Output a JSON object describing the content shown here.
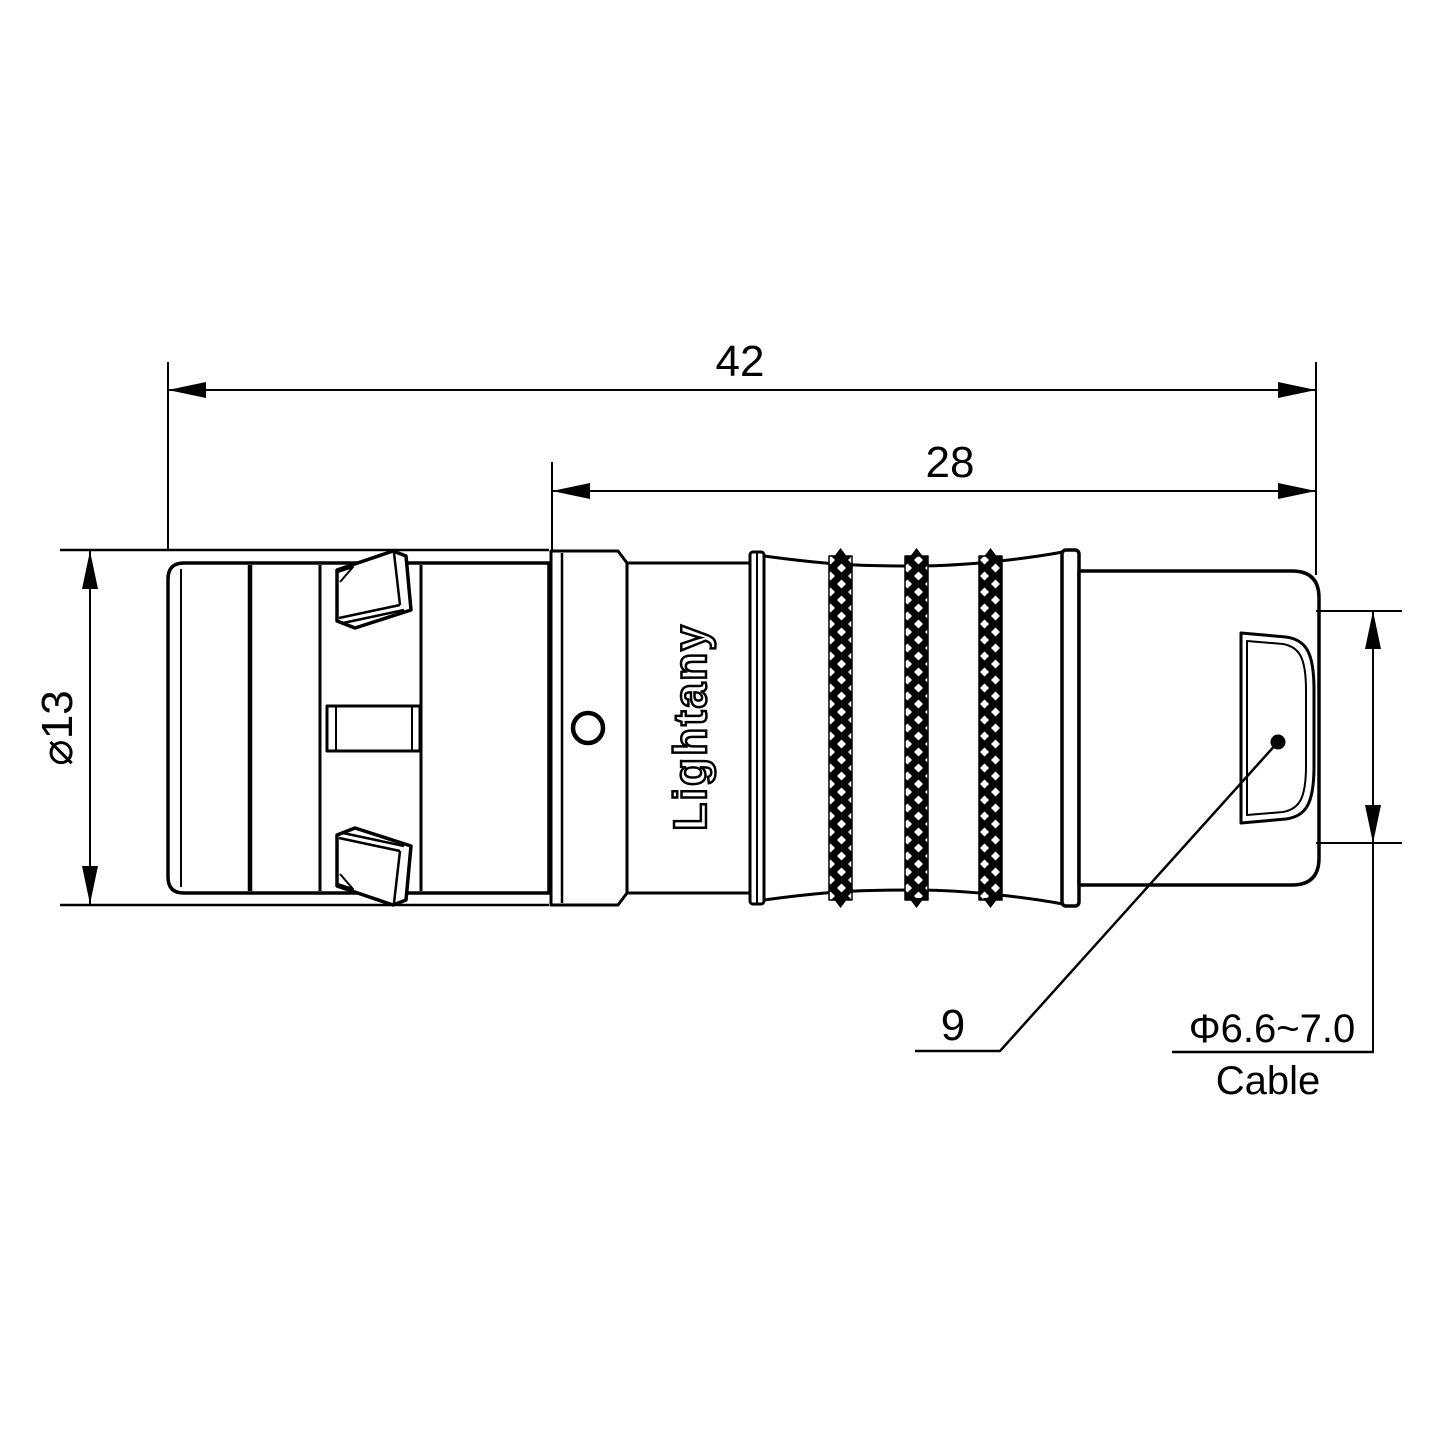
{
  "drawing": {
    "dimensions": {
      "overall_length": "42",
      "rear_length": "28",
      "shell_diameter": "⌀13",
      "nut_size": "9",
      "cable_spec": "Φ6.6~7.0",
      "cable_label": "Cable"
    },
    "branding": {
      "watermark": "Lightany",
      "engraving": "Lightany"
    },
    "colors": {
      "line": "#000000",
      "background": "#ffffff",
      "watermark": "#e05a6e"
    }
  }
}
